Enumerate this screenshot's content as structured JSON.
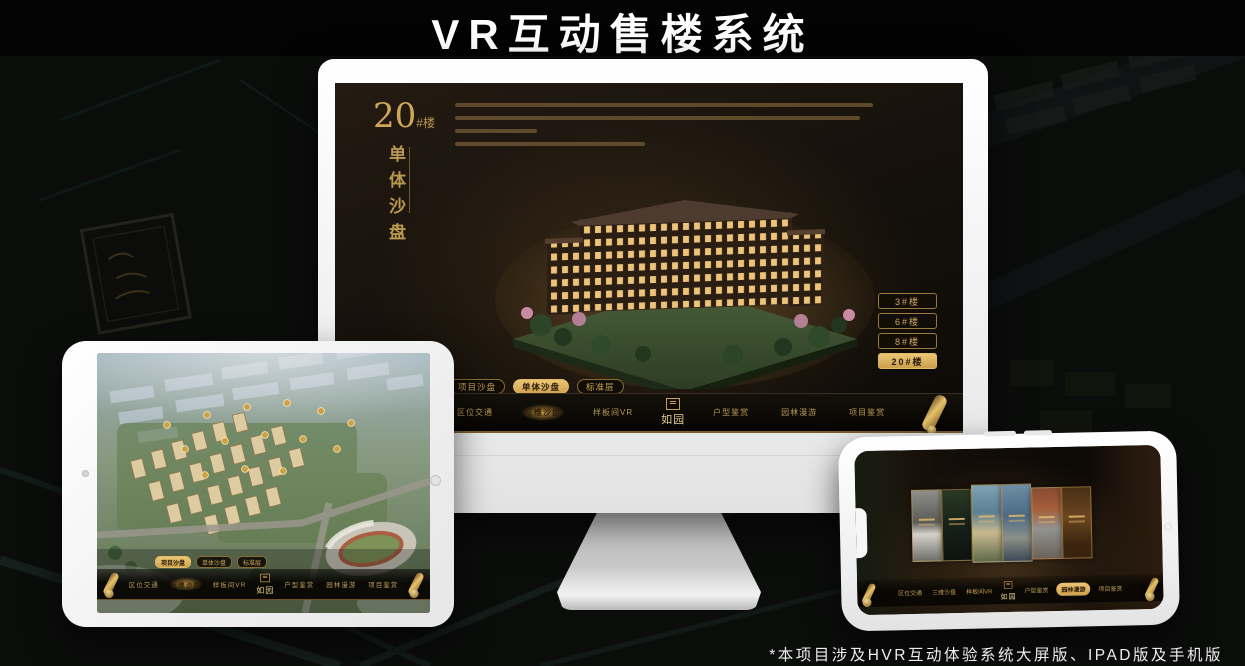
{
  "header": {
    "title": "VR互动售楼系统"
  },
  "footer": {
    "note": "*本项目涉及HVR互动体验系统大屏版、IPAD版及手机版"
  },
  "app": {
    "logo_text": "如园",
    "nav_items": [
      "区位交通",
      "三维沙盘",
      "样板间VR",
      "户型鉴赏",
      "园林漫游",
      "项目鉴赏"
    ],
    "tabs": [
      "项目沙盘",
      "单体沙盘",
      "标准层"
    ]
  },
  "monitor_screen": {
    "building_number": "20",
    "building_number_suffix": "#楼",
    "subtitle_vertical": "单体沙盘",
    "floor_buttons": [
      "3#楼",
      "6#楼",
      "8#楼",
      "20#楼"
    ],
    "active_floor_button": "20#楼",
    "active_tab": "单体沙盘",
    "active_nav_item": "三维沙盘"
  },
  "tablet_screen": {
    "active_tab": "项目沙盘",
    "active_nav_item": "三维沙盘"
  },
  "phone_screen": {
    "active_nav_item": "园林漫游"
  },
  "colors": {
    "gold_accent": "#d9b266",
    "gold_dim": "#8a6c35",
    "screen_dark": "#14100a",
    "title_white": "#ffffff"
  }
}
